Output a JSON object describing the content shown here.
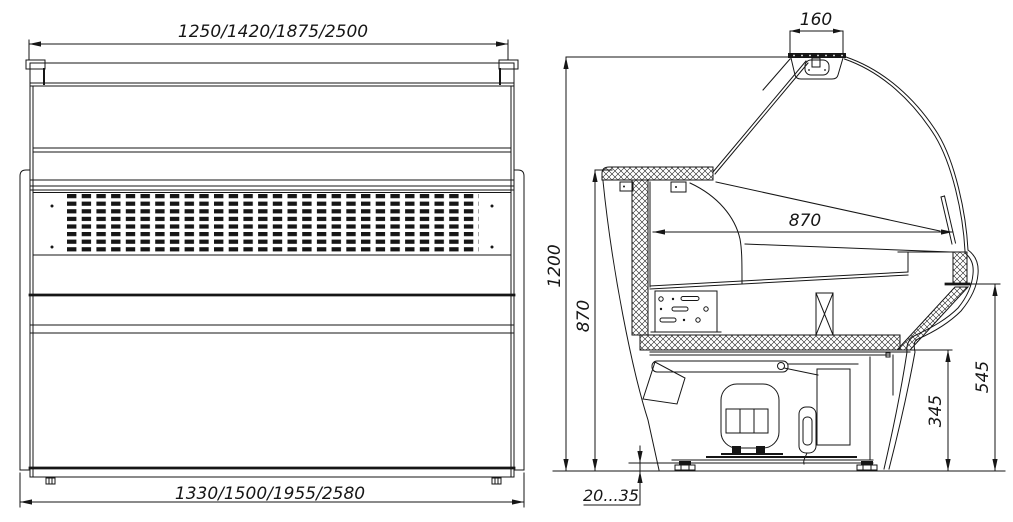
{
  "drawing": {
    "front_view": {
      "dim_top_widths": "1250/1420/1875/2500",
      "dim_bottom_widths": "1330/1500/1955/2580"
    },
    "side_view": {
      "dim_canopy_depth": "160",
      "dim_overall_height": "1200",
      "dim_back_height": "870",
      "dim_display_depth": "870",
      "dim_front_height": "545",
      "dim_front_lower_height": "345",
      "dim_foot_adjustment": "20...35"
    }
  }
}
